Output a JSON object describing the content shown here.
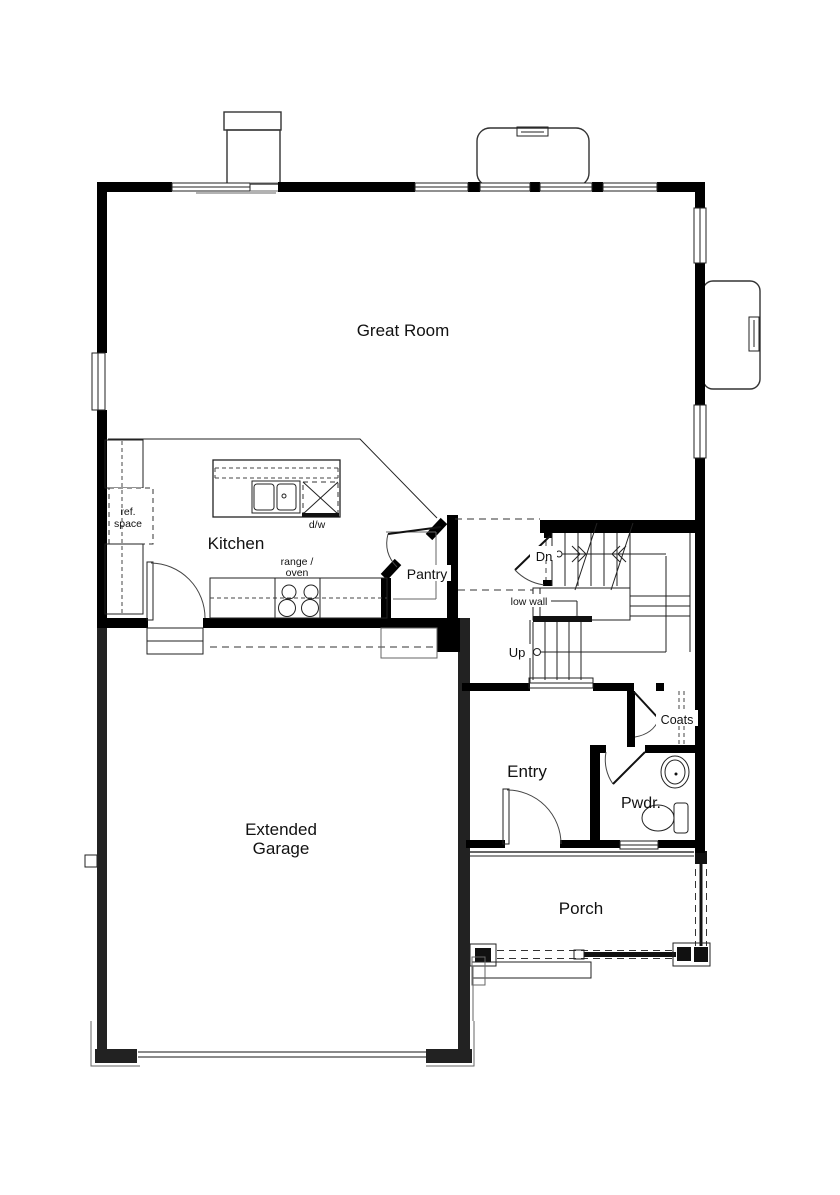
{
  "plan_title": "First Floor Plan",
  "rooms": {
    "great_room": "Great Room",
    "kitchen": "Kitchen",
    "pantry": "Pantry",
    "extended_garage_line1": "Extended",
    "extended_garage_line2": "Garage",
    "entry": "Entry",
    "porch": "Porch",
    "powder": "Pwdr.",
    "coats": "Coats"
  },
  "annotations": {
    "ref_space_line1": "ref.",
    "ref_space_line2": "space",
    "range_oven_line1": "range /",
    "range_oven_line2": "oven",
    "dishwasher": "d/w",
    "stairs_down": "Dn",
    "stairs_up": "Up",
    "low_wall": "low wall"
  },
  "colors": {
    "wall": "#000000",
    "garage_wall": "#222222",
    "line": "#222222",
    "text": "#111111",
    "background": "#ffffff"
  }
}
